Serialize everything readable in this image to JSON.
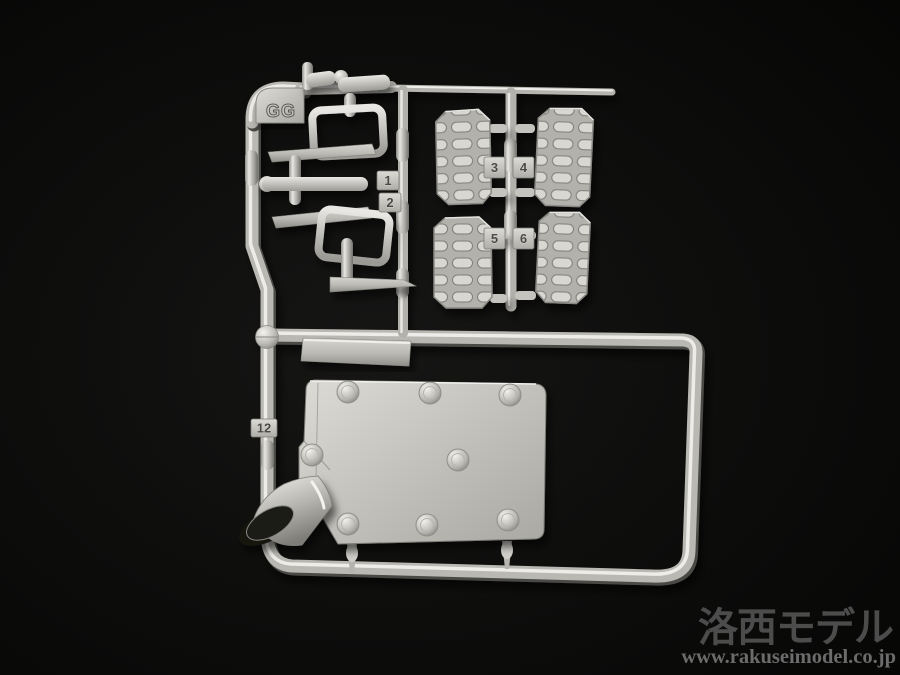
{
  "sprue": {
    "gate_label": "GG",
    "part_tags": [
      {
        "label": "1"
      },
      {
        "label": "2"
      },
      {
        "label": "3"
      },
      {
        "label": "4"
      },
      {
        "label": "5"
      },
      {
        "label": "6"
      },
      {
        "label": "12"
      }
    ]
  },
  "watermark": {
    "logo_text": "洛西モデル",
    "url_text": "www.rakuseimodel.co.jp"
  },
  "colors": {
    "background": "#0c0c0b",
    "sprue_base": "#b9b8b3",
    "sprue_highlight": "#edece8",
    "sprue_shadow": "#4a4945",
    "plate_face": "#c7c6c1",
    "watermark_logo": "#4c4c4c",
    "watermark_url": "#6c6c6c"
  }
}
